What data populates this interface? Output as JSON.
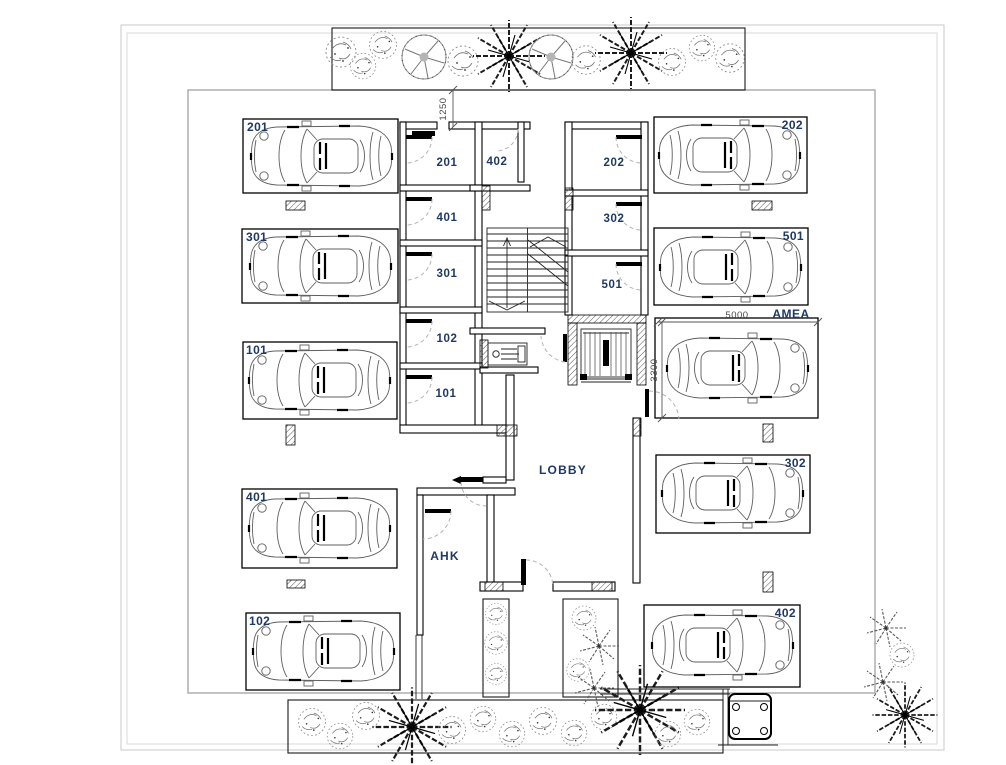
{
  "plan": {
    "parking": [
      {
        "label": "201"
      },
      {
        "label": "301"
      },
      {
        "label": "101"
      },
      {
        "label": "401"
      },
      {
        "label": "102"
      },
      {
        "label": "202"
      },
      {
        "label": "501"
      },
      {
        "label": "302"
      },
      {
        "label": "402"
      }
    ],
    "accessible_spot": {
      "label": "AMEA",
      "width": "5000",
      "depth": "3300"
    },
    "storage": [
      {
        "label": "201"
      },
      {
        "label": "402"
      },
      {
        "label": "202"
      },
      {
        "label": "401"
      },
      {
        "label": "302"
      },
      {
        "label": "301"
      },
      {
        "label": "501"
      },
      {
        "label": "102"
      },
      {
        "label": "101"
      }
    ],
    "areas": {
      "lobby": "LOBBY",
      "ahk": "AHK"
    },
    "dims": {
      "entry": "1250"
    },
    "colors": {
      "label": "#1f3864",
      "dim": "#4a4a4a"
    }
  }
}
